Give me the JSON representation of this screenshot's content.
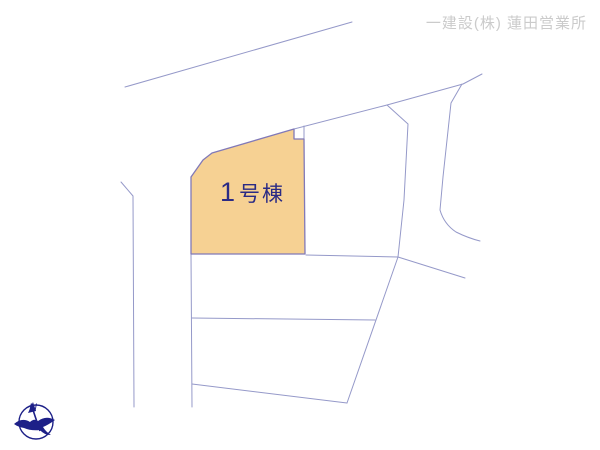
{
  "header": {
    "company": "一建設(株) 蓮田営業所"
  },
  "parcel": {
    "number": "1",
    "suffix": "号棟",
    "fill_color": "#F6D193",
    "label_color": "#2B2B85"
  },
  "compass": {
    "north_label": "N"
  },
  "colors": {
    "line": "#9599C9",
    "parcel_border": "#8179B8",
    "header_text": "#CBCBCB",
    "compass": "#1D2088",
    "background": "#FFFFFF"
  }
}
